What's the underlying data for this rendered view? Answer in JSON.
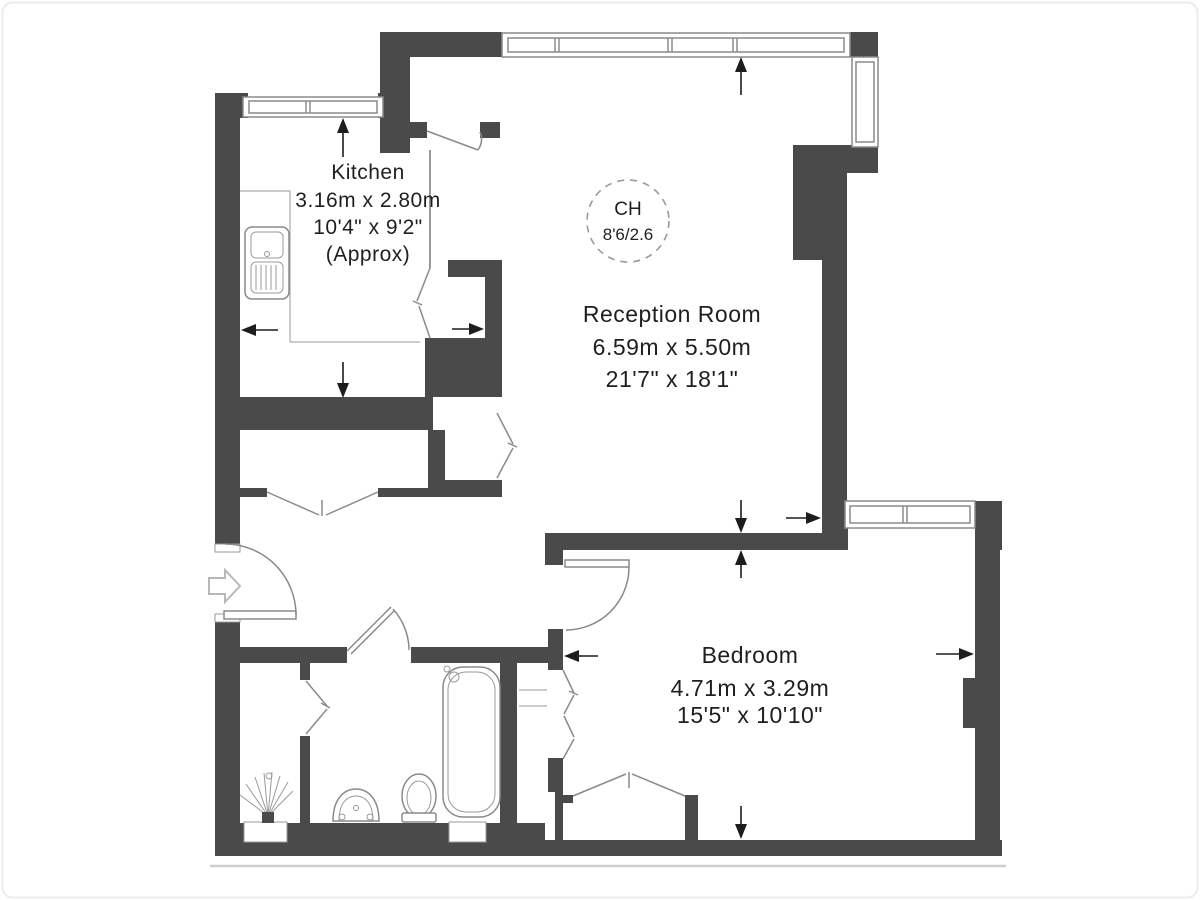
{
  "plan": {
    "rooms": [
      {
        "name": "Kitchen",
        "dim_metric": "3.16m x 2.80m",
        "dim_imperial": "10'4\" x 9'2\"",
        "note": "(Approx)"
      },
      {
        "name": "Reception Room",
        "dim_metric": "6.59m x 5.50m",
        "dim_imperial": "21'7\" x 18'1\"",
        "note": ""
      },
      {
        "name": "Bedroom",
        "dim_metric": "4.71m x 3.29m",
        "dim_imperial": "15'5\" x 10'10\"",
        "note": ""
      }
    ],
    "ceiling_height": {
      "label": "CH",
      "value": "8'6/2.6"
    },
    "colors": {
      "wall": "#4a4a4b",
      "line": "#8a8a8a",
      "text": "#1f1f1f"
    }
  }
}
